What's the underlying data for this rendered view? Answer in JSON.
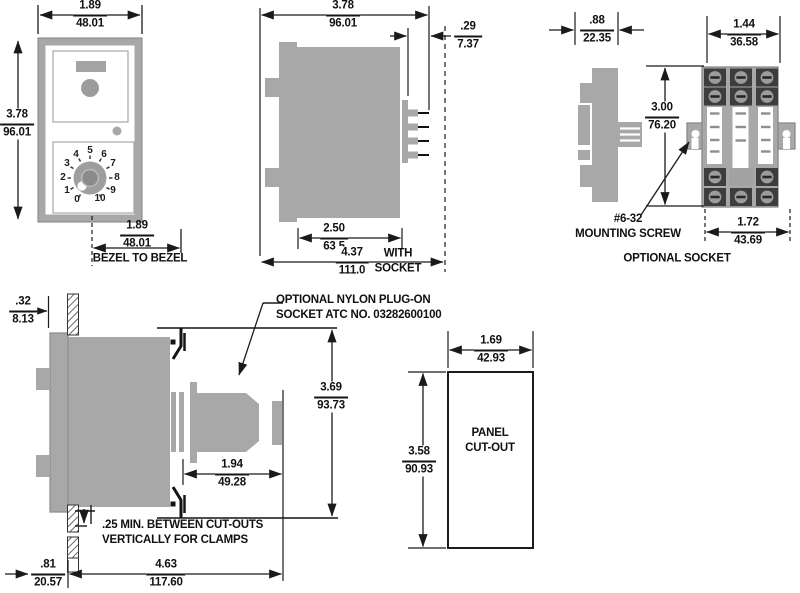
{
  "dims": {
    "front_width": {
      "in": "1.89",
      "mm": "48.01"
    },
    "front_height": {
      "in": "3.78",
      "mm": "96.01"
    },
    "bezel_to_bezel": {
      "in": "1.89",
      "mm": "48.01"
    },
    "side_height": {
      "in": "3.78",
      "mm": "96.01"
    },
    "terminal_depth": {
      "in": ".29",
      "mm": "7.37"
    },
    "case_depth": {
      "in": "2.50",
      "mm": "63.5"
    },
    "depth_with_socket": {
      "in": "4.37",
      "mm": "111.0"
    },
    "socket_depth": {
      "in": ".88",
      "mm": "22.35"
    },
    "socket_width": {
      "in": "1.44",
      "mm": "36.58"
    },
    "socket_height": {
      "in": "3.00",
      "mm": "76.20"
    },
    "socket_mount_spacing": {
      "in": "1.72",
      "mm": "43.69"
    },
    "panel_thickness": {
      "in": ".32",
      "mm": "8.13"
    },
    "behind_panel_depth": {
      "in": "3.69",
      "mm": "93.73"
    },
    "socket_clearance": {
      "in": "1.94",
      "mm": "49.28"
    },
    "front_projection": {
      "in": ".81",
      "mm": "20.57"
    },
    "total_depth": {
      "in": "4.63",
      "mm": "117.60"
    },
    "cutout_width": {
      "in": "1.69",
      "mm": "42.93"
    },
    "cutout_height": {
      "in": "3.58",
      "mm": "90.93"
    }
  },
  "labels": {
    "bezel_to_bezel": "BEZEL TO BEZEL",
    "with_socket_line1": "WITH",
    "with_socket_line2": "SOCKET",
    "mounting_screw_line1": "#6-32",
    "mounting_screw_line2": "MOUNTING SCREW",
    "optional_socket": "OPTIONAL SOCKET",
    "plug_on_socket_line1": "OPTIONAL NYLON PLUG-ON",
    "plug_on_socket_line2": "SOCKET ATC NO. 03282600100",
    "clamp_note_line1": ".25 MIN. BETWEEN CUT-OUTS",
    "clamp_note_line2": "VERTICALLY FOR CLAMPS",
    "panel_cutout_line1": "PANEL",
    "panel_cutout_line2": "CUT-OUT"
  },
  "dial_numbers": [
    "0",
    "1",
    "2",
    "3",
    "4",
    "5",
    "6",
    "7",
    "8",
    "9",
    "10"
  ],
  "colors": {
    "body_gray": "#a8a8a8",
    "line_black": "#1a1a1a",
    "screw_dark": "#3d3d3d",
    "background": "#ffffff"
  }
}
